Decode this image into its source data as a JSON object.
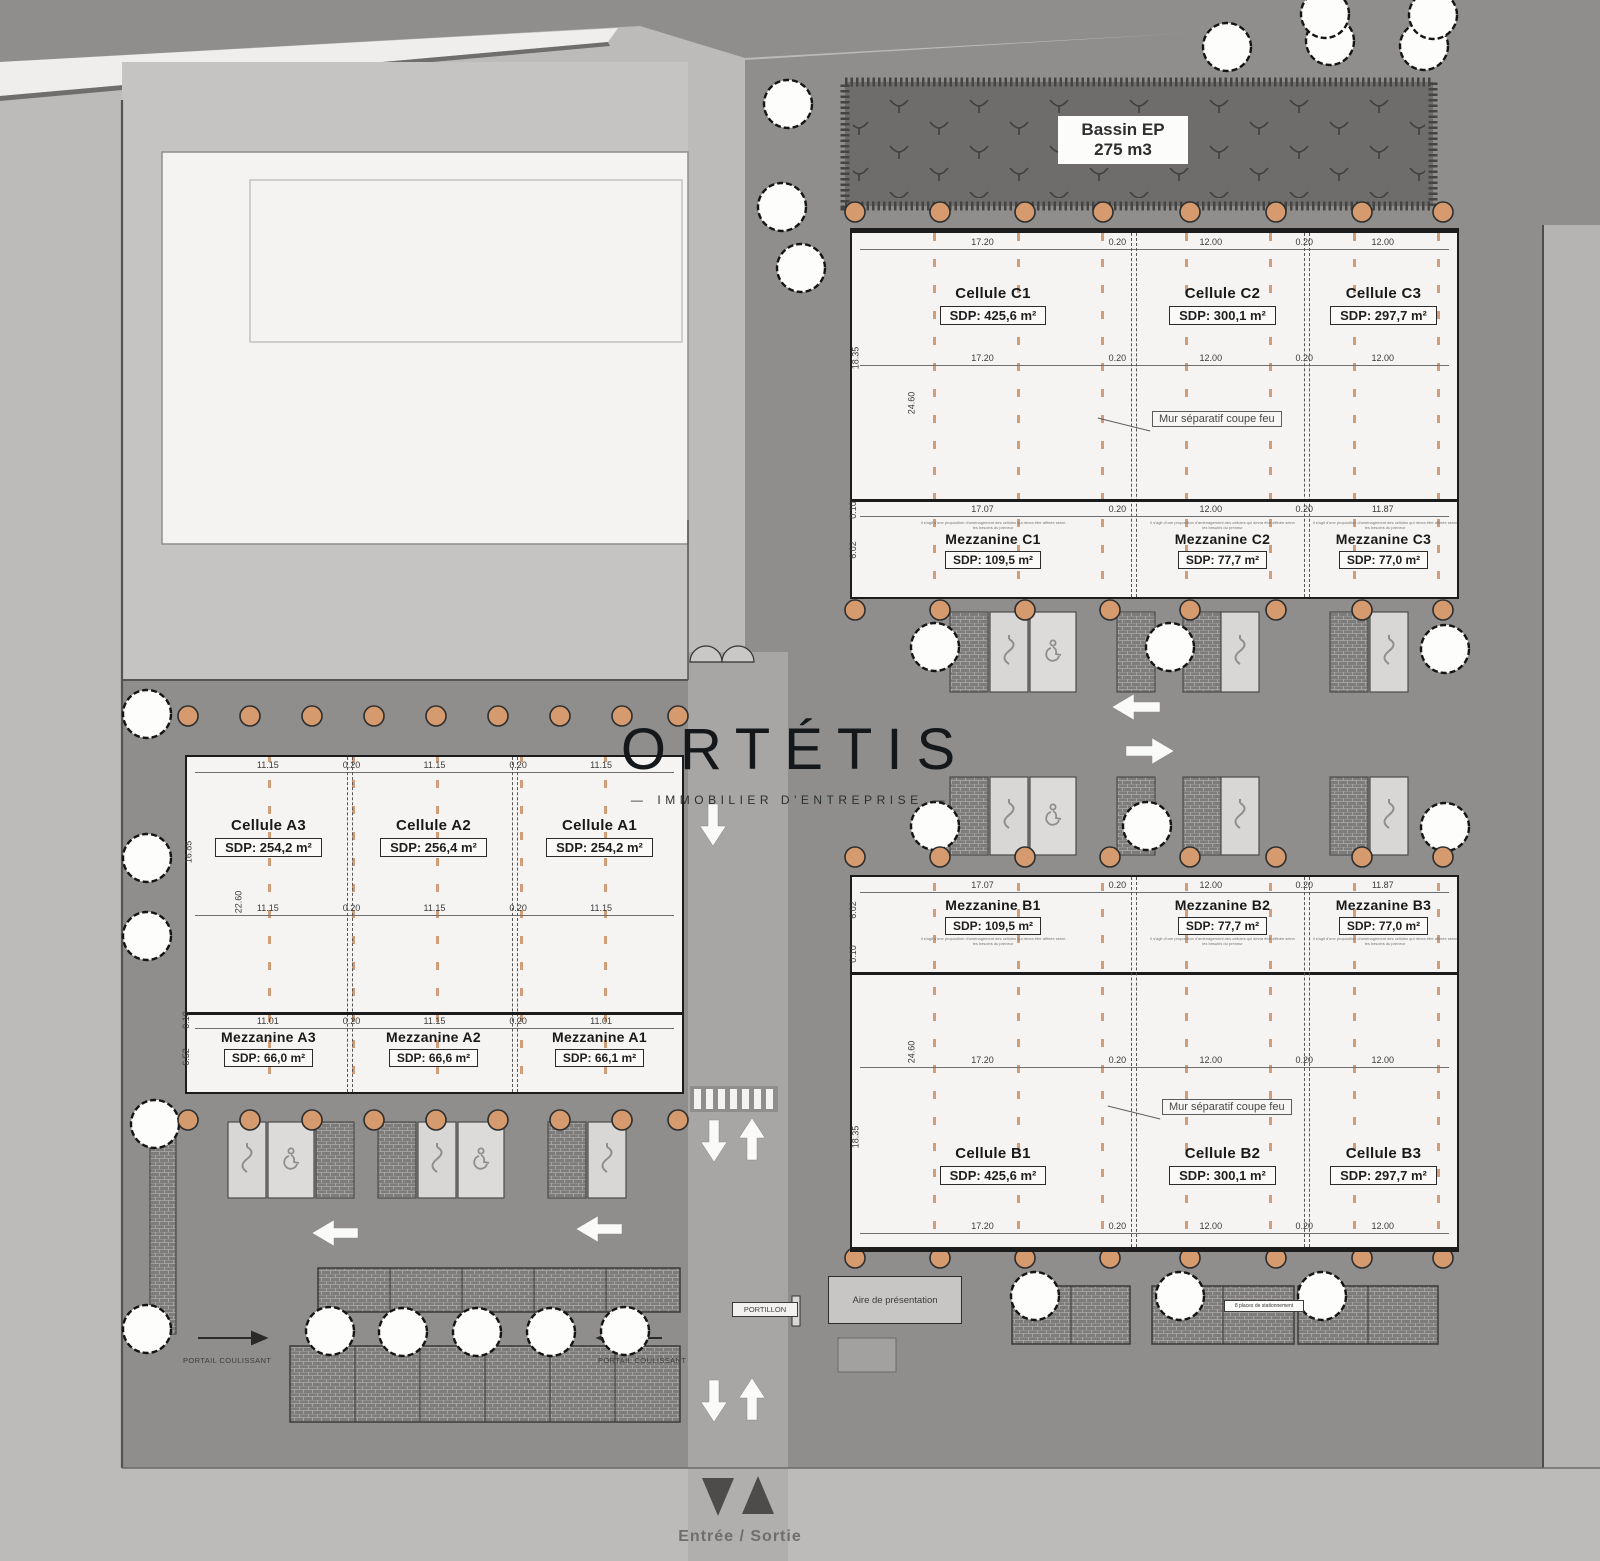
{
  "logo": {
    "title": "ORTÉTIS",
    "subtitle": "IMMOBILIER D'ENTREPRISE",
    "dash": "—"
  },
  "basin": {
    "line1": "Bassin EP",
    "line2": "275 m3"
  },
  "firewall_label": "Mur séparatif coupe feu",
  "note": "Il s'agit d'une proposition d'aménagement des cellules qui devra être affinée selon les besoins du preneur",
  "buildings": {
    "c": {
      "cells": [
        {
          "name": "Cellule C1",
          "sdp": "SDP: 425,6 m²"
        },
        {
          "name": "Cellule C2",
          "sdp": "SDP: 300,1 m²"
        },
        {
          "name": "Cellule C3",
          "sdp": "SDP: 297,7 m²"
        }
      ],
      "mezz": [
        {
          "name": "Mezzanine C1",
          "sdp": "SDP: 109,5 m²"
        },
        {
          "name": "Mezzanine C2",
          "sdp": "SDP: 77,7 m²"
        },
        {
          "name": "Mezzanine C3",
          "sdp": "SDP: 77,0 m²"
        }
      ],
      "top_dims": [
        "17.20",
        "0.20",
        "12.00",
        "0.20",
        "12.00"
      ],
      "mid_dims": [
        "17.20",
        "0.20",
        "12.00",
        "0.20",
        "12.00"
      ],
      "mezz_dims": [
        "17.07",
        "0.20",
        "12.00",
        "0.20",
        "11.87"
      ],
      "side_dims": [
        "18.35",
        "24.60",
        "0.10",
        "6.02"
      ]
    },
    "a": {
      "cells": [
        {
          "name": "Cellule A3",
          "sdp": "SDP: 254,2 m²"
        },
        {
          "name": "Cellule A2",
          "sdp": "SDP: 256,4 m²"
        },
        {
          "name": "Cellule A1",
          "sdp": "SDP: 254,2 m²"
        }
      ],
      "mezz": [
        {
          "name": "Mezzanine A3",
          "sdp": "SDP: 66,0 m²"
        },
        {
          "name": "Mezzanine A2",
          "sdp": "SDP: 66,6 m²"
        },
        {
          "name": "Mezzanine A1",
          "sdp": "SDP: 66,1 m²"
        }
      ],
      "top_dims": [
        "11.15",
        "0.20",
        "11.15",
        "0.20",
        "11.15"
      ],
      "mid_dims": [
        "11.15",
        "0.20",
        "11.15",
        "0.20",
        "11.15"
      ],
      "mezz_dims": [
        "11.01",
        "0.20",
        "11.15",
        "0.20",
        "11.01"
      ],
      "side_dims": [
        "16.85",
        "22.60",
        "0.10",
        "6.52"
      ]
    },
    "b": {
      "cells": [
        {
          "name": "Cellule B1",
          "sdp": "SDP: 425,6 m²"
        },
        {
          "name": "Cellule B2",
          "sdp": "SDP: 300,1 m²"
        },
        {
          "name": "Cellule B3",
          "sdp": "SDP: 297,7 m²"
        }
      ],
      "mezz": [
        {
          "name": "Mezzanine B1",
          "sdp": "SDP: 109,5 m²"
        },
        {
          "name": "Mezzanine B2",
          "sdp": "SDP: 77,7 m²"
        },
        {
          "name": "Mezzanine B3",
          "sdp": "SDP: 77,0 m²"
        }
      ],
      "mezz_dims": [
        "17.07",
        "0.20",
        "12.00",
        "0.20",
        "11.87"
      ],
      "mid_dims": [
        "17.20",
        "0.20",
        "12.00",
        "0.20",
        "12.00"
      ],
      "bottom_dims": [
        "17.20",
        "0.20",
        "12.00",
        "0.20",
        "12.00"
      ],
      "side_dims": [
        "6.02",
        "0.10",
        "24.60",
        "18.35"
      ]
    }
  },
  "site": {
    "portillon": "PORTILLON",
    "portail_left": "PORTAIL COULISSANT",
    "portail_right": "PORTAIL COULISSANT",
    "aire": "Aire de présentation",
    "entree": "Entrée / Sortie",
    "parking_note": "8 places de stationnement"
  },
  "colors": {
    "accent_column": "#c6895a",
    "asphalt": "#8f8e8d",
    "basin": "#6e6d6c"
  }
}
